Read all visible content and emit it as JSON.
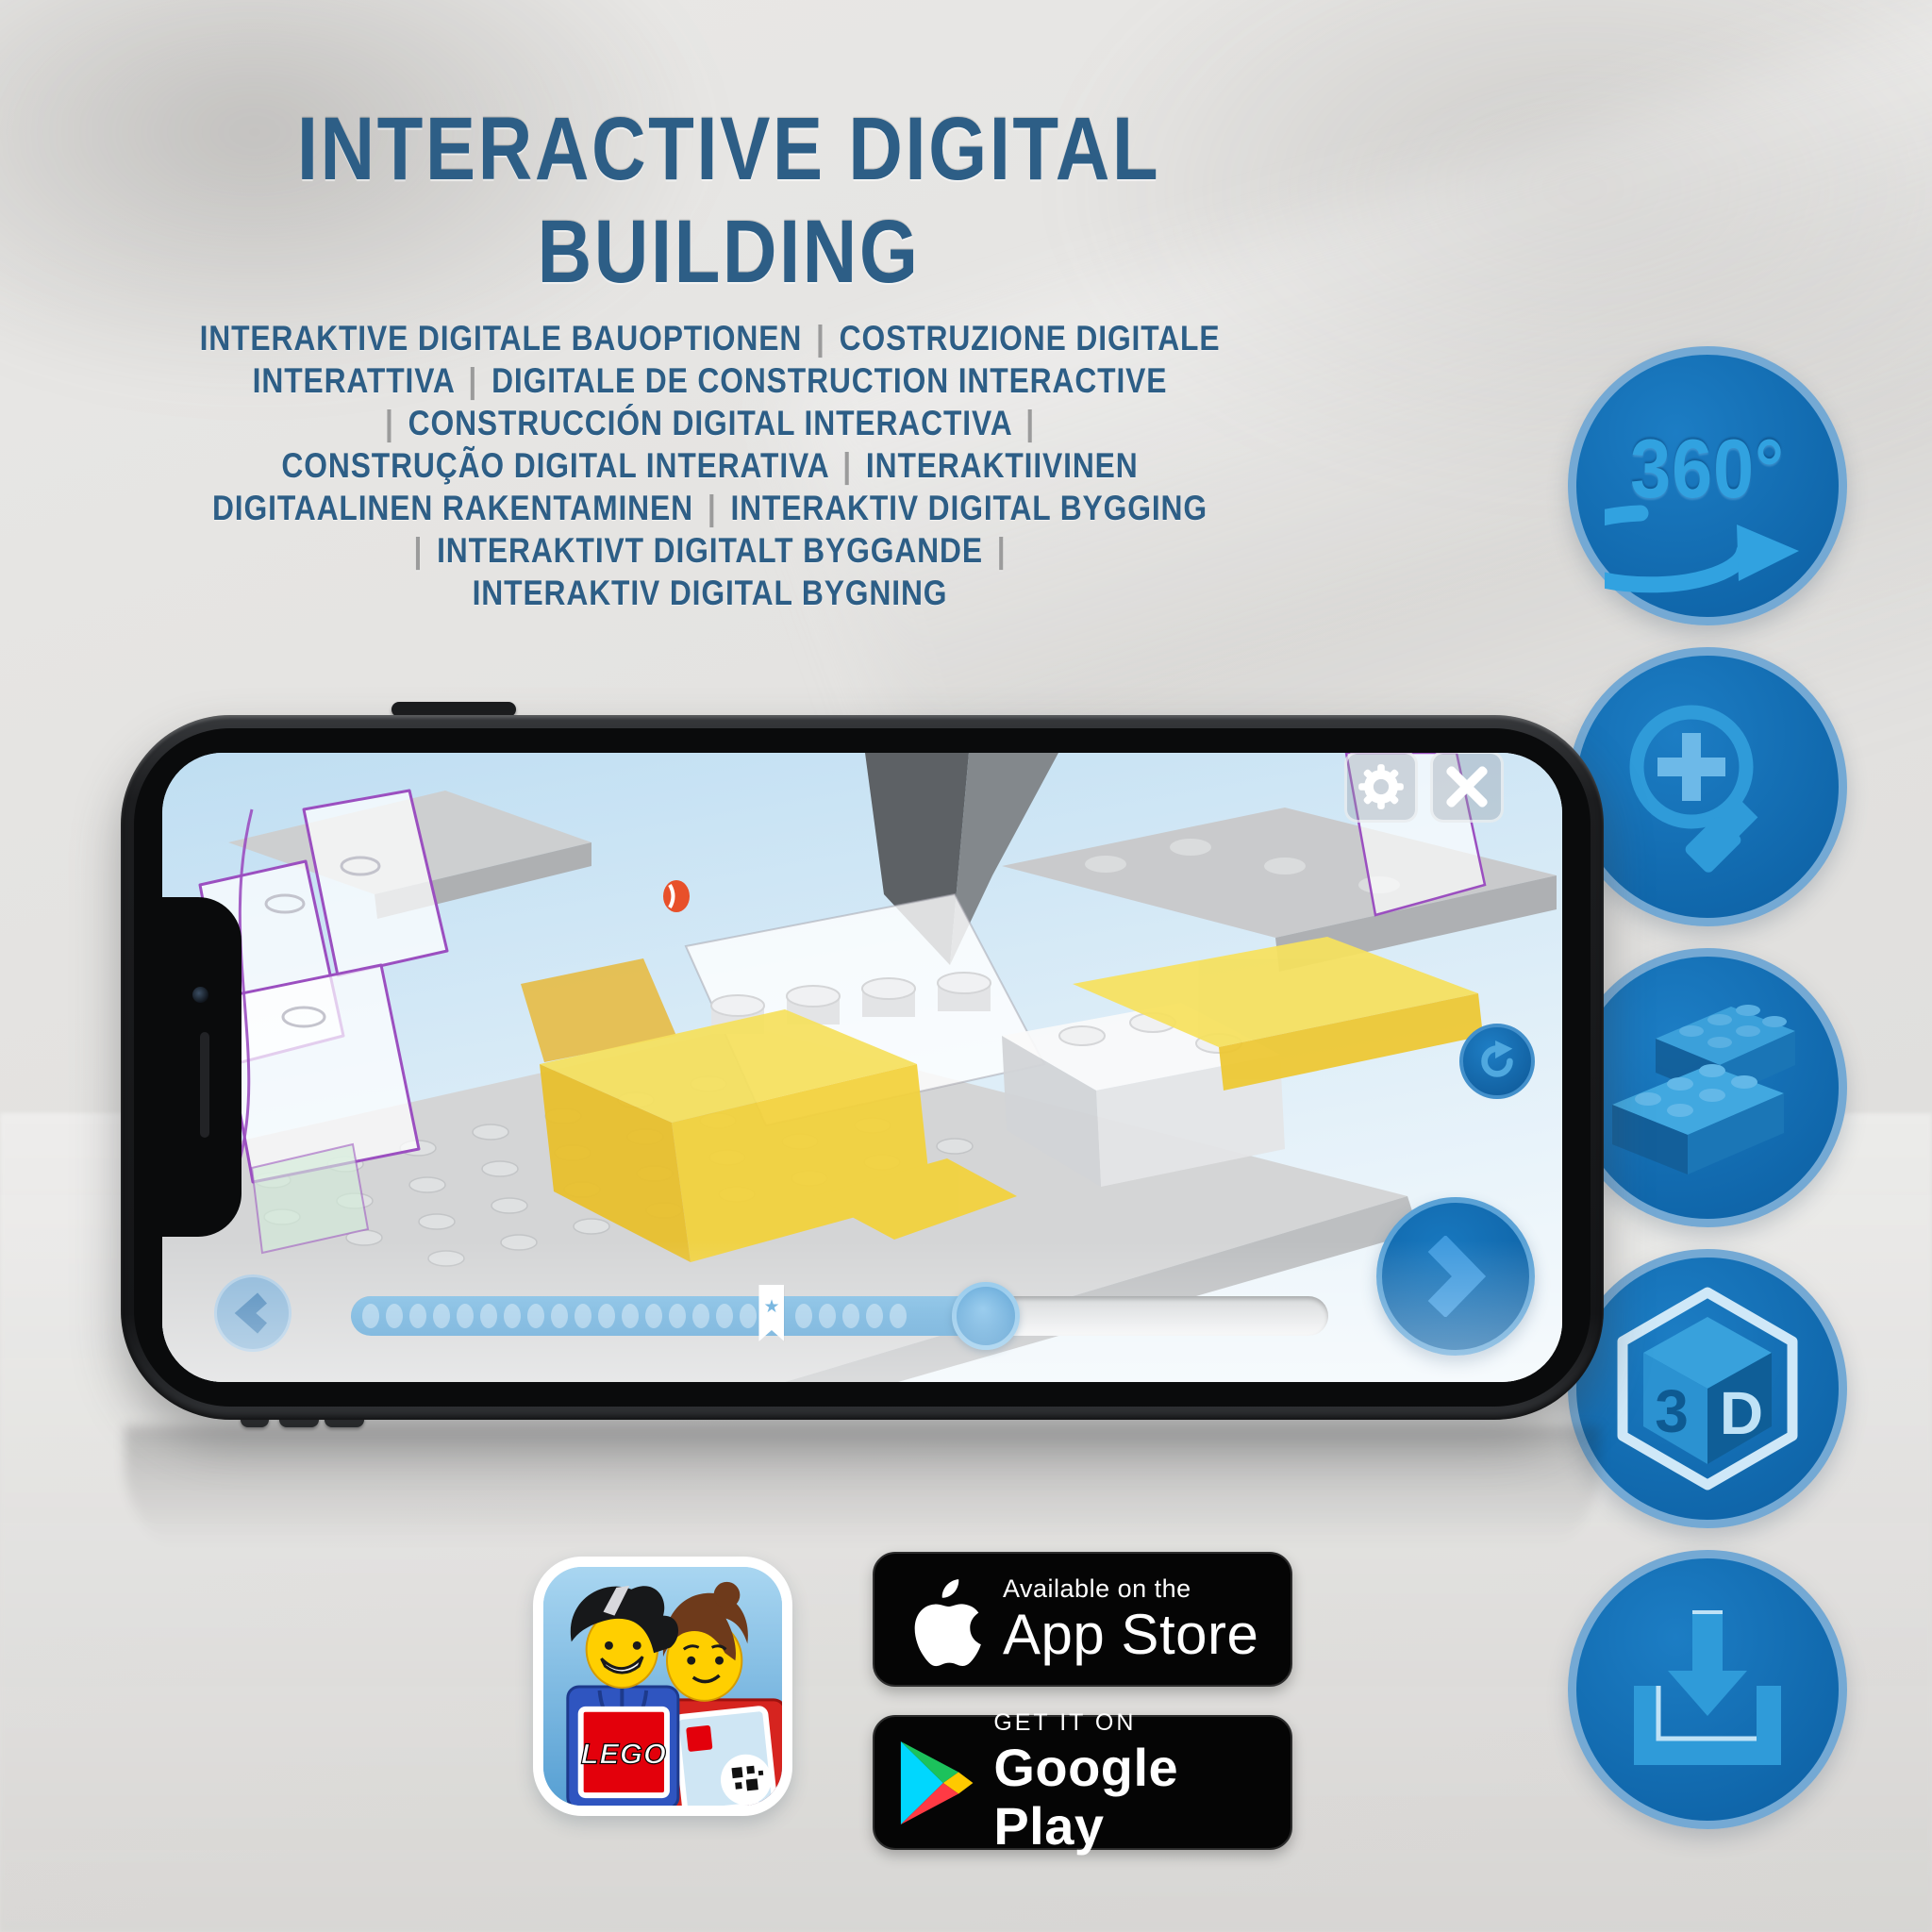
{
  "title": {
    "text": "INTERACTIVE DIGITAL BUILDING",
    "color": "#2d5e86"
  },
  "subtitle": {
    "text_color": "#2d5e86",
    "pipe_color": "#9b9b9b",
    "lines": [
      "INTERAKTIVE DIGITALE BAUOPTIONEN | COSTRUZIONE DIGITALE",
      "INTERATTIVA | DIGITALE DE CONSTRUCTION INTERACTIVE",
      "| CONSTRUCCIÓN DIGITAL INTERACTIVA |",
      "CONSTRUÇÃO DIGITAL INTERATIVA | INTERAKTIIVINEN",
      "DIGITAALINEN RAKENTAMINEN | INTERAKTIV DIGITAL BYGGING",
      "| INTERAKTIVT DIGITALT BYGGANDE |",
      "INTERAKTIV DIGITAL BYGNING"
    ]
  },
  "feature_icons": {
    "circle_color": "#1371b7",
    "rim_color": "#74a9d4",
    "glyph_color": "#2f9bd9",
    "items": [
      {
        "name": "360-rotation",
        "label": "360°"
      },
      {
        "name": "zoom-in-magnifier"
      },
      {
        "name": "lego-bricks"
      },
      {
        "name": "3d-view-cube",
        "cube_left_label": "3",
        "cube_right_label": "D"
      },
      {
        "name": "download"
      }
    ]
  },
  "phone": {
    "app_ui": {
      "settings_button_icon": "gear",
      "close_button_icon": "close-x",
      "refresh_button_icon": "rotate-arrow",
      "prev_button_icon": "chevron-left",
      "next_button_icon": "chevron-right",
      "progress": {
        "fill_percent": 65,
        "bookmark_percent": 43,
        "bookmark_star_char": "★",
        "dots_before_bookmark": 17,
        "dots_after_bookmark": 5
      }
    }
  },
  "badges": {
    "app_store": {
      "line1": "Available on the",
      "line2": "App Store"
    },
    "google_play": {
      "line1": "GET IT ON",
      "line2": "Google Play"
    },
    "lego_app_icon": {
      "logo_text": "LEGO"
    }
  }
}
